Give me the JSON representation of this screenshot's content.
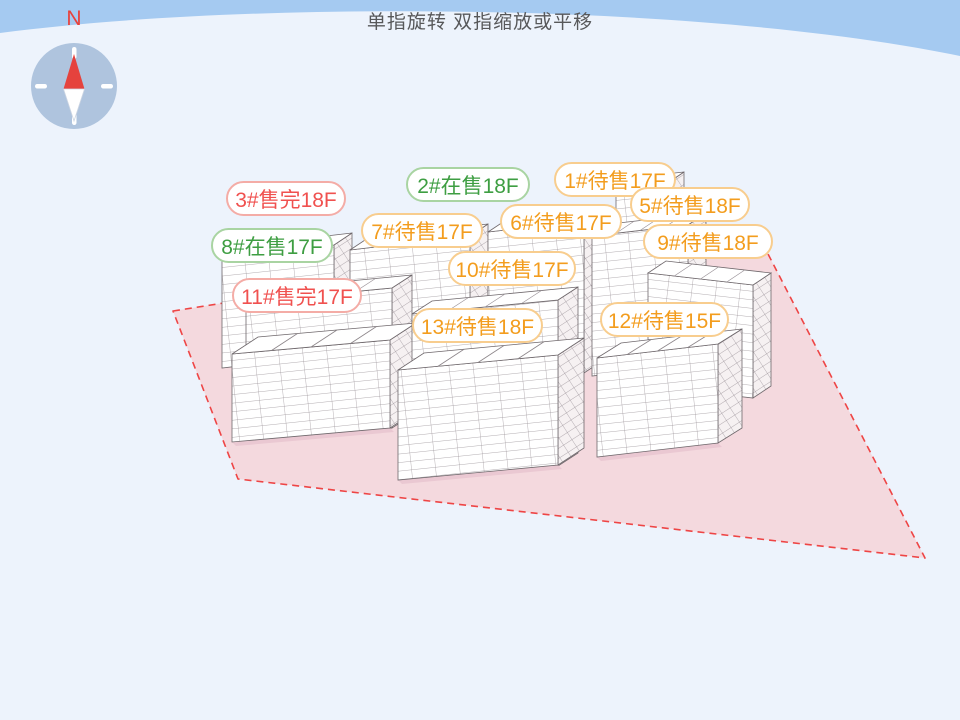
{
  "header": {
    "gesture_hint": "单指旋转 双指缩放或平移"
  },
  "compass": {
    "north_label": "N"
  },
  "colors": {
    "sky_band": "#a5caf1",
    "background": "#edf3fc",
    "site_fill": "#f4d9de",
    "site_border": "#ee4545",
    "status_pending_text": "#f39d1e",
    "status_pending_border": "#f8cd8e",
    "status_selling_text": "#3e9e42",
    "status_selling_border": "#a9d4a2",
    "status_soldout_text": "#f0514f",
    "status_soldout_border": "#f4aca6"
  },
  "status_legend": {
    "pending": "待售",
    "selling": "在售",
    "soldout": "售完"
  },
  "buildings": [
    {
      "id": "1#",
      "status": "待售",
      "floors": "17F",
      "state": "pending",
      "label": "1#待售17F"
    },
    {
      "id": "2#",
      "status": "在售",
      "floors": "18F",
      "state": "selling",
      "label": "2#在售18F"
    },
    {
      "id": "3#",
      "status": "售完",
      "floors": "18F",
      "state": "soldout",
      "label": "3#售完18F"
    },
    {
      "id": "5#",
      "status": "待售",
      "floors": "18F",
      "state": "pending",
      "label": "5#待售18F"
    },
    {
      "id": "6#",
      "status": "待售",
      "floors": "17F",
      "state": "pending",
      "label": "6#待售17F"
    },
    {
      "id": "7#",
      "status": "待售",
      "floors": "17F",
      "state": "pending",
      "label": "7#待售17F"
    },
    {
      "id": "8#",
      "status": "在售",
      "floors": "17F",
      "state": "selling",
      "label": "8#在售17F"
    },
    {
      "id": "9#",
      "status": "待售",
      "floors": "18F",
      "state": "pending",
      "label": "9#待售18F"
    },
    {
      "id": "10#",
      "status": "待售",
      "floors": "17F",
      "state": "pending",
      "label": "10#待售17F"
    },
    {
      "id": "11#",
      "status": "售完",
      "floors": "17F",
      "state": "soldout",
      "label": "11#售完17F"
    },
    {
      "id": "12#",
      "status": "待售",
      "floors": "15F",
      "state": "pending",
      "label": "12#待售15F"
    },
    {
      "id": "13#",
      "status": "待售",
      "floors": "18F",
      "state": "pending",
      "label": "13#待售18F"
    }
  ]
}
